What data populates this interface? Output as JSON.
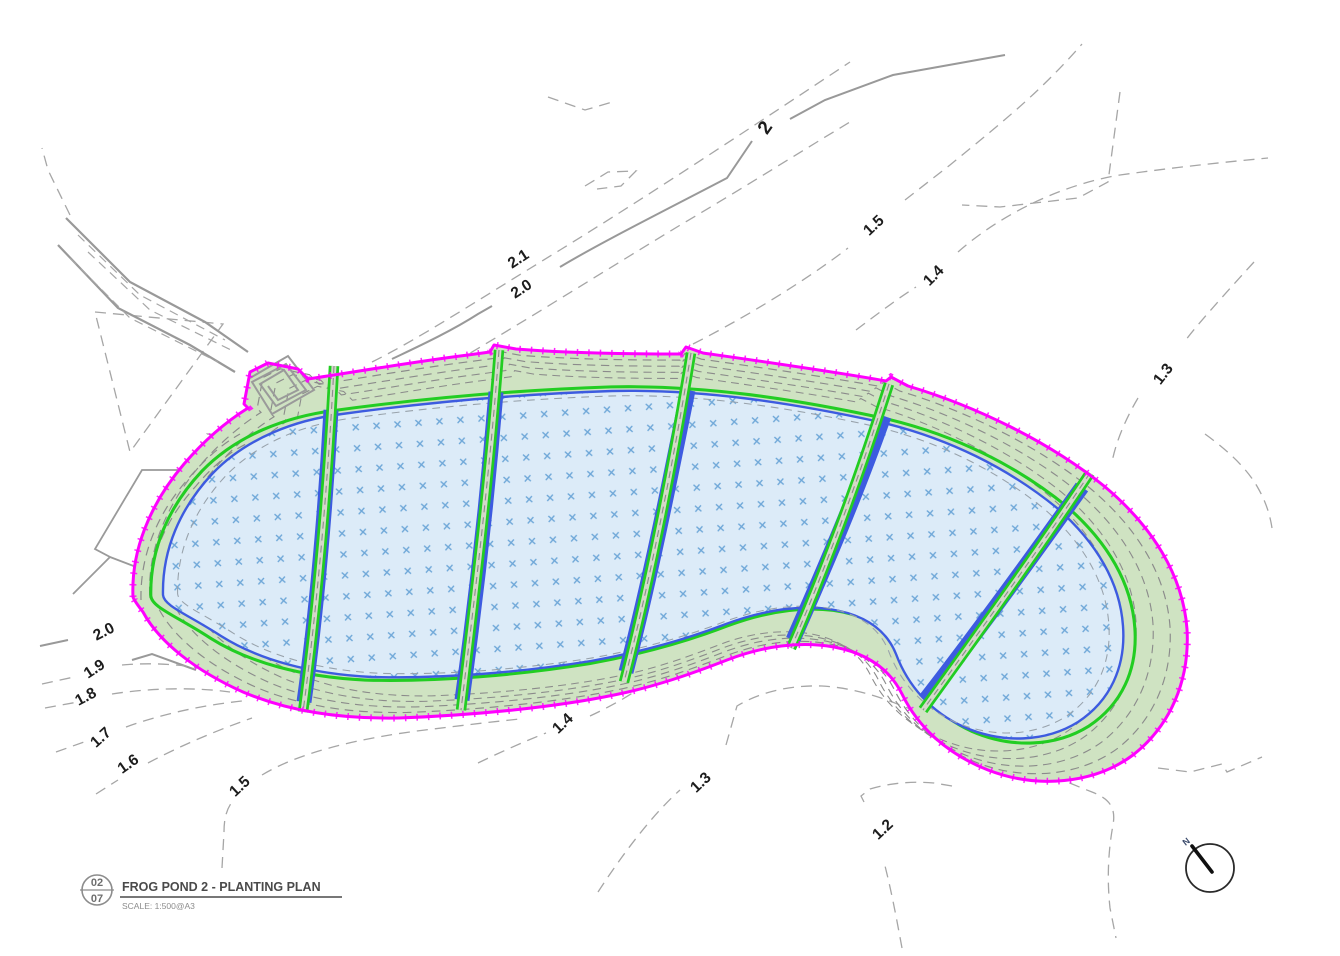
{
  "title_block": {
    "detail_number": "02",
    "sheet_number": "07",
    "title": "FROG POND 2 - PLANTING PLAN",
    "scale_note": "SCALE: 1:500@A3"
  },
  "north_arrow": {
    "label": "N"
  },
  "contour_labels": [
    {
      "text": "2",
      "x": 770,
      "y": 131,
      "rot": -55,
      "size": 19
    },
    {
      "text": "2.1",
      "x": 521,
      "y": 263,
      "rot": -33
    },
    {
      "text": "2.0",
      "x": 524,
      "y": 293,
      "rot": -33
    },
    {
      "text": "1.5",
      "x": 877,
      "y": 229,
      "rot": -43
    },
    {
      "text": "1.4",
      "x": 937,
      "y": 279,
      "rot": -45
    },
    {
      "text": "1.3",
      "x": 1167,
      "y": 377,
      "rot": -52
    },
    {
      "text": "2.0",
      "x": 106,
      "y": 636,
      "rot": -27
    },
    {
      "text": "1.9",
      "x": 97,
      "y": 673,
      "rot": -33
    },
    {
      "text": "1.8",
      "x": 88,
      "y": 701,
      "rot": -28
    },
    {
      "text": "1.7",
      "x": 104,
      "y": 741,
      "rot": -42
    },
    {
      "text": "1.6",
      "x": 131,
      "y": 768,
      "rot": -35
    },
    {
      "text": "1.5",
      "x": 243,
      "y": 790,
      "rot": -43
    },
    {
      "text": "1.4",
      "x": 566,
      "y": 727,
      "rot": -43
    },
    {
      "text": "1.3",
      "x": 704,
      "y": 786,
      "rot": -43
    },
    {
      "text": "1.2",
      "x": 886,
      "y": 833,
      "rot": -43
    }
  ],
  "colors": {
    "boundary": "#ff00ff",
    "band": "#cfe3c2",
    "marginal": "#22cd22",
    "waterline": "#3d5be0",
    "water": "#dcebf8",
    "hatch": "#6ea7d8",
    "contour": "#a6a6a6",
    "contour-index": "#999999"
  }
}
